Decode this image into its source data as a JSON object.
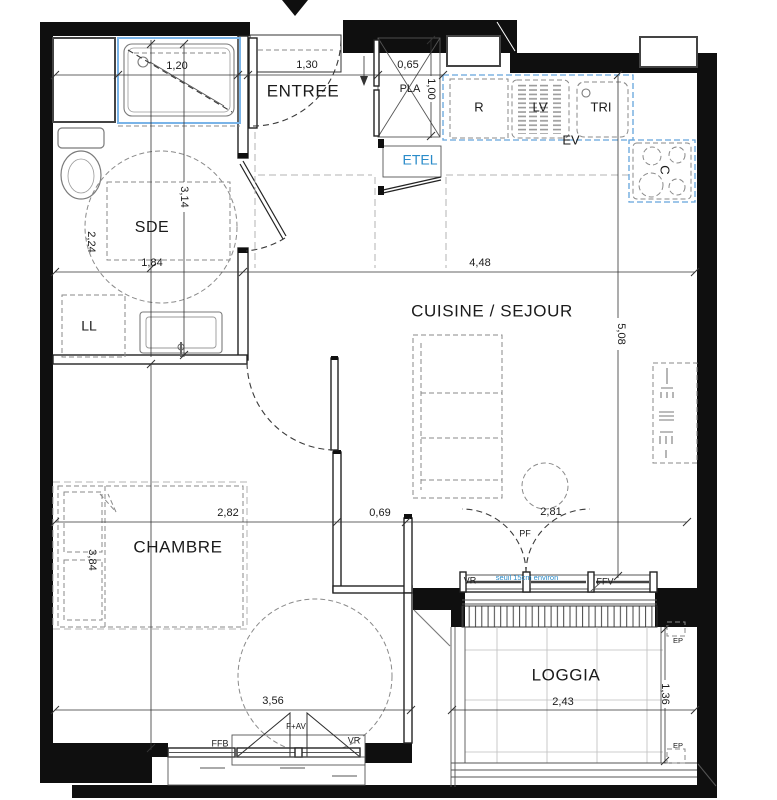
{
  "rooms": {
    "entree": "ENTREE",
    "sde": "SDE",
    "cuisine_sejour": "CUISINE / SEJOUR",
    "chambre": "CHAMBRE",
    "loggia": "LOGGIA"
  },
  "fixtures": {
    "pla": "PLA",
    "etel": "ETEL",
    "r": "R",
    "lv": "LV",
    "tri": "TRI",
    "ev": "EV",
    "c": "C",
    "ll": "LL"
  },
  "openings": {
    "pf": "PF",
    "vr_loggia": "VR",
    "seuil": "seuil 15cm environ",
    "ffv": "FFV",
    "ffb": "FFB",
    "fav": "F+AV",
    "vr_chambre": "VR",
    "ep_top": "EP",
    "ep_bottom": "EP"
  },
  "dimensions": {
    "shower_width": "1,20",
    "entree_width": "1,30",
    "pla_width": "0,65",
    "pla_depth": "1,00",
    "sde_depth": "2,24",
    "sde_height": "3,14",
    "sde_width": "1,84",
    "sejour_width": "4,48",
    "sejour_height": "5,08",
    "chambre_width": "2,82",
    "passage_width": "0,69",
    "sejour_lower_width": "2,81",
    "chambre_height": "3,84",
    "chambre_bottom_width": "3,56",
    "loggia_width": "2,43",
    "loggia_depth": "1,36"
  },
  "colors": {
    "wall": "#0f0f0f",
    "counter_blue": "#63a5dc",
    "shower_blue": "#7ab4e8",
    "label_blue": "#2a8bc9"
  }
}
